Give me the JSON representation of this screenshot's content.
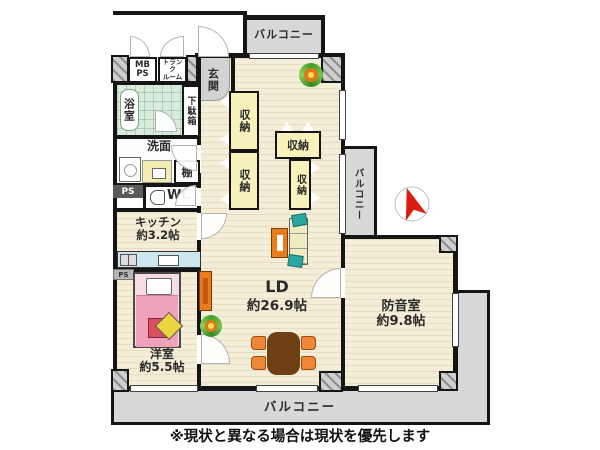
{
  "note": "※現状と異なる場合は現状を優先します",
  "balconies": {
    "top": "バルコニー",
    "right": "バルコニー",
    "bottom": "バルコニー"
  },
  "rooms": {
    "ld": {
      "name": "LD",
      "size": "約26.9帖"
    },
    "soundproof": {
      "name": "防音室",
      "size": "約9.8帖"
    },
    "western": {
      "name": "洋室",
      "size": "約5.5帖"
    },
    "kitchen": {
      "name": "キッチン",
      "size": "約3.2帖"
    },
    "bath": {
      "name": "浴室"
    },
    "washroom": {
      "name": "洗面"
    },
    "wc": {
      "name": "WC"
    },
    "genkan": {
      "name": "玄関"
    },
    "getabako": {
      "name": "下駄箱"
    },
    "shelf": {
      "name": "棚"
    },
    "trunk": {
      "line1": "トランク",
      "line2": "ルーム"
    },
    "mbps": {
      "line1": "MB",
      "line2": "PS"
    },
    "ps_upper": {
      "name": "PS"
    },
    "ps_lower": {
      "name": "PS"
    }
  },
  "storages": [
    {
      "label": "収納"
    },
    {
      "label": "収納"
    },
    {
      "label": "収納"
    },
    {
      "label": "収納"
    }
  ],
  "colors": {
    "wall": "#151515",
    "floor": "#f4eed8",
    "balcony": "#d8d8d8",
    "genkan": "#d2d2d2",
    "bath": "#d9ecdb",
    "storage": "#f7f2bb",
    "counter": "#cde7f0",
    "bed-pink": "#efa3ba",
    "bed-frame": "#f6dde2",
    "cushion-red": "#db4f63",
    "cushion-yellow": "#ead43f",
    "furniture-orange": "#ea7c1e",
    "chair-orange": "#ef8638",
    "table-brown": "#6e4014",
    "sofa-cream": "#f1ebc4",
    "sofa-teal": "#2aa8a0",
    "plant-orange": "#e07818",
    "compass-red": "#dd1c10"
  }
}
